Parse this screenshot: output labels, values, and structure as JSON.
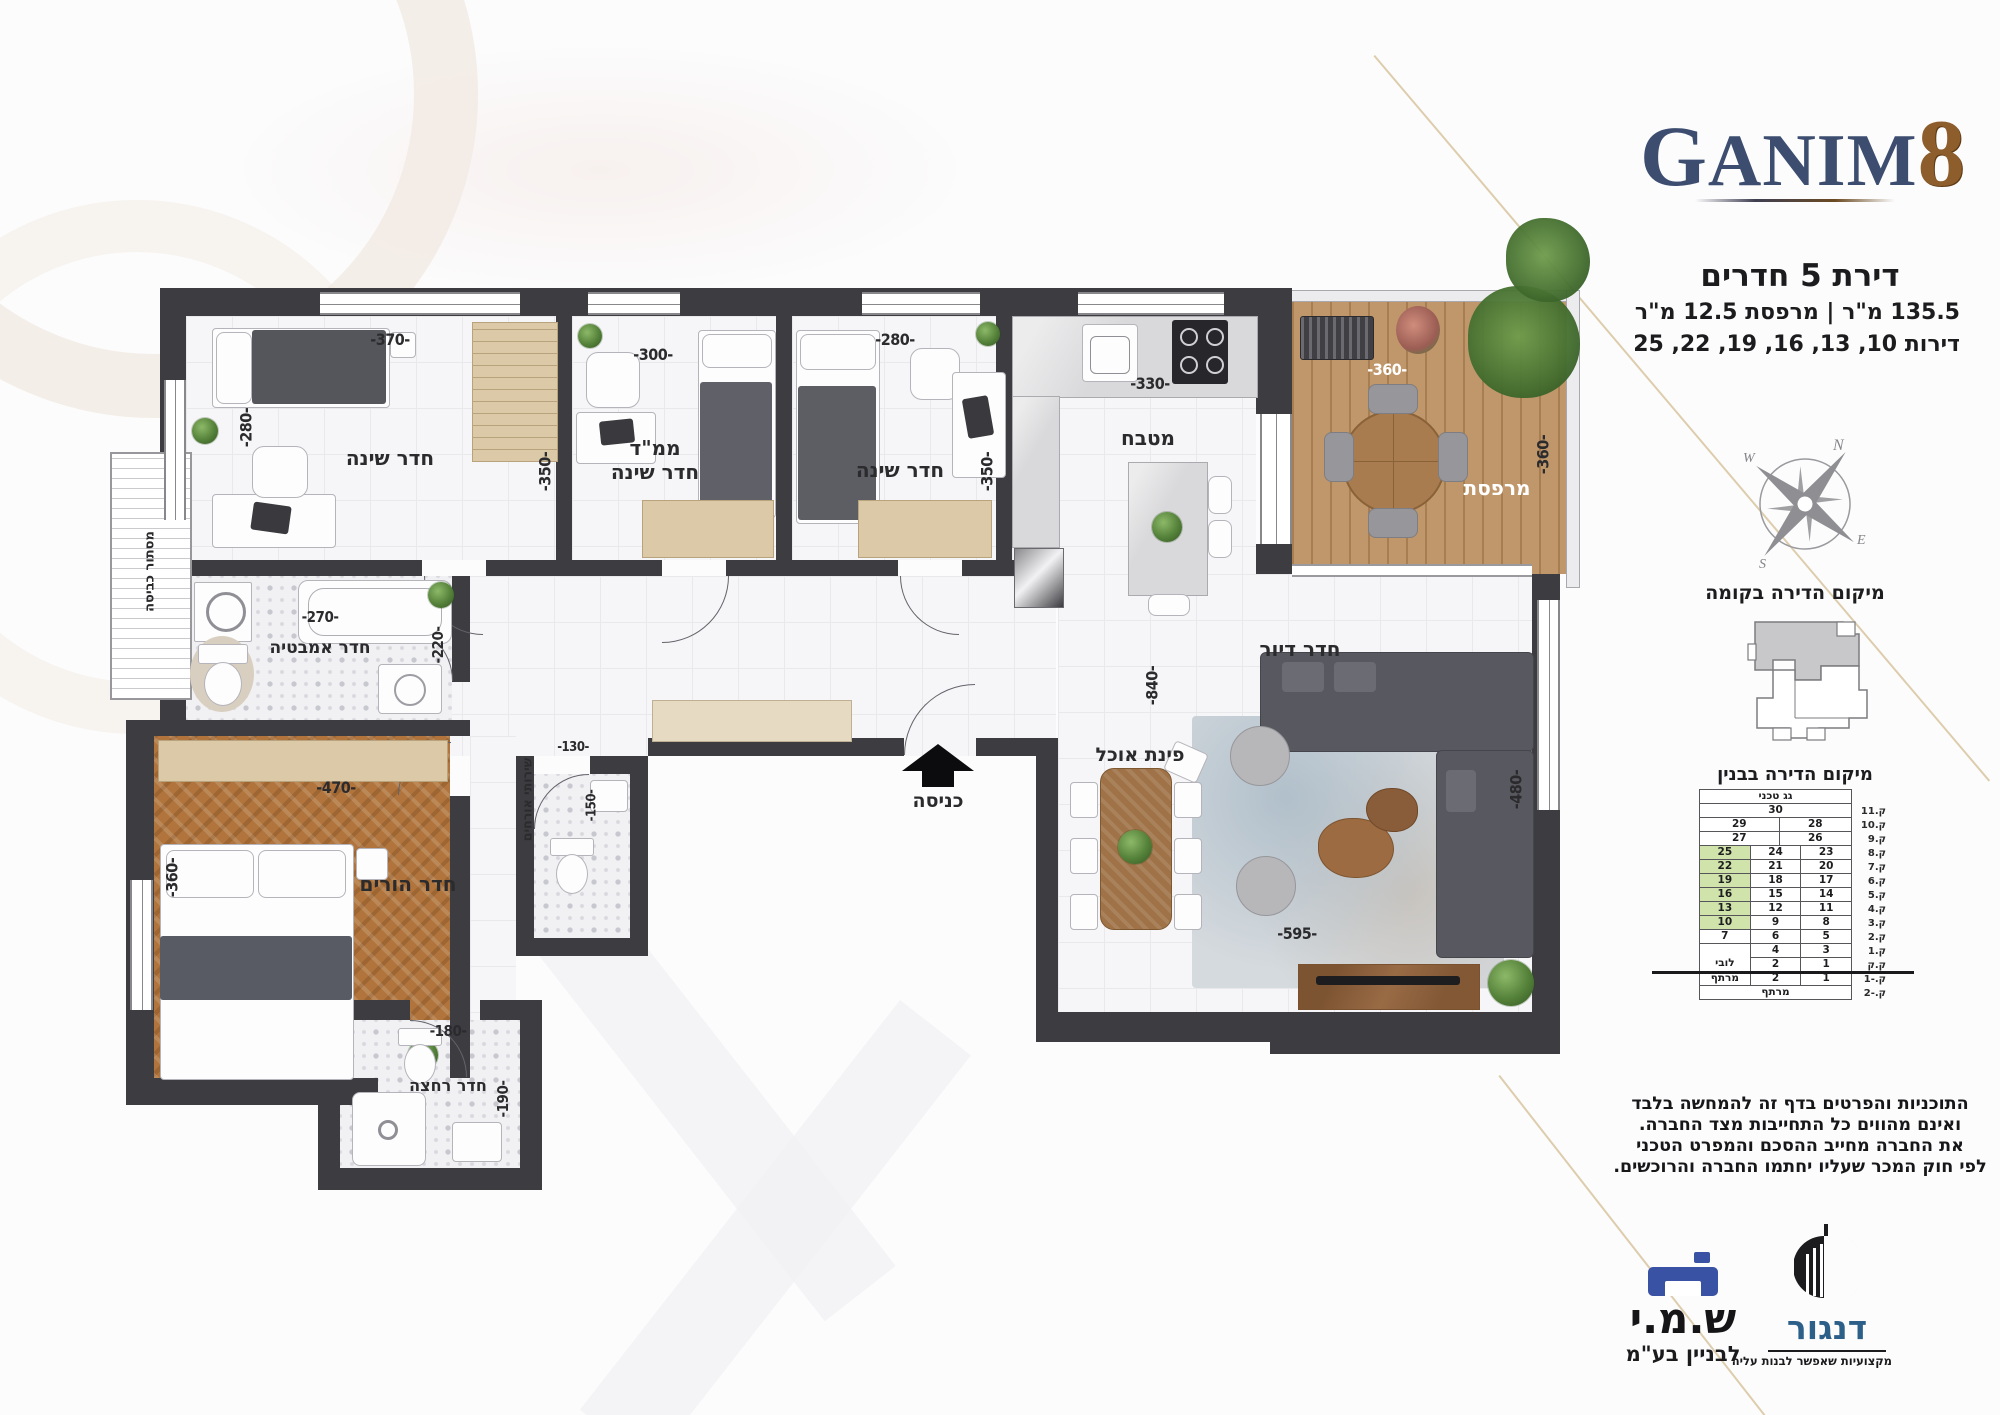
{
  "header": {
    "logo_text": "Ganim",
    "logo_number": "8",
    "title": "דירת 5 חדרים",
    "area_line": "135.5 מ\"ר | מרפסת 12.5 מ\"ר",
    "units_line": "דירות 10, 13, 16, 19, 22, 25"
  },
  "compass": {
    "n": "N",
    "e": "E",
    "s": "S",
    "w": "W"
  },
  "floor_location": {
    "title": "מיקום הדירה בקומה"
  },
  "building_location": {
    "title": "מיקום הדירה בבנין",
    "rows": [
      {
        "cells": [
          {
            "t": "גג טכני",
            "g": 1
          }
        ],
        "floor": ""
      },
      {
        "cells": [
          {
            "t": "30",
            "g": 1
          }
        ],
        "floor": "ק.11"
      },
      {
        "cells": [
          {
            "t": "29",
            "g": 1.1
          },
          {
            "t": "28",
            "g": 1
          }
        ],
        "floor": "ק.10"
      },
      {
        "cells": [
          {
            "t": "27",
            "g": 1.1
          },
          {
            "t": "26",
            "g": 1
          }
        ],
        "floor": "ק.9"
      },
      {
        "cells": [
          {
            "t": "25",
            "hl": true
          },
          {
            "t": "24"
          },
          {
            "t": "23"
          }
        ],
        "floor": "ק.8"
      },
      {
        "cells": [
          {
            "t": "22",
            "hl": true
          },
          {
            "t": "21"
          },
          {
            "t": "20"
          }
        ],
        "floor": "ק.7"
      },
      {
        "cells": [
          {
            "t": "19",
            "hl": true
          },
          {
            "t": "18"
          },
          {
            "t": "17"
          }
        ],
        "floor": "ק.6"
      },
      {
        "cells": [
          {
            "t": "16",
            "hl": true
          },
          {
            "t": "15"
          },
          {
            "t": "14"
          }
        ],
        "floor": "ק.5"
      },
      {
        "cells": [
          {
            "t": "13",
            "hl": true
          },
          {
            "t": "12"
          },
          {
            "t": "11"
          }
        ],
        "floor": "ק.4"
      },
      {
        "cells": [
          {
            "t": "10",
            "hl": true
          },
          {
            "t": "9"
          },
          {
            "t": "8"
          }
        ],
        "floor": "ק.3"
      },
      {
        "cells": [
          {
            "t": "7"
          },
          {
            "t": "6"
          },
          {
            "t": "5"
          }
        ],
        "floor": "ק.2"
      },
      {
        "cells": [
          {
            "t": "",
            "merge": "nb"
          },
          {
            "t": "4"
          },
          {
            "t": "3"
          }
        ],
        "floor": "ק.1"
      },
      {
        "cells": [
          {
            "t": "לובי",
            "merge": "nt"
          },
          {
            "t": "2"
          },
          {
            "t": "1"
          }
        ],
        "floor": "ק.ק"
      },
      {
        "cells": [
          {
            "t": "מרתף"
          },
          {
            "t": "2"
          },
          {
            "t": "1"
          }
        ],
        "floor": "ק.-1"
      },
      {
        "cells": [
          {
            "t": "מרתף",
            "g": 1
          }
        ],
        "floor": "ק.-2"
      }
    ]
  },
  "disclaimer": [
    "התוכניות והפרטים בדף זה להמחשה בלבד",
    "ואינם מהווים כל התחייבות מצד החברה.",
    "את החברה מחייב ההסכם והמפרט הטכני",
    "לפי חוק המכר שעליו יחתמו החברה והרוכשים."
  ],
  "brands": {
    "shami": {
      "name": "ש.מ.י",
      "sub": "לבניין בע\"מ"
    },
    "dangor": {
      "name": "דנגור",
      "tagline": "מקצועיות שאפשר לבנות עליה"
    }
  },
  "plan": {
    "entrance_label": "כניסה",
    "rooms": {
      "bedroom1": {
        "label": "חדר שינה",
        "dim_w": "-370-",
        "dim_h": "-280-"
      },
      "mamad": {
        "label_line1": "ממ\"ד",
        "label_line2": "חדר שינה",
        "dim_w": "-300-",
        "dim_h": "-350-"
      },
      "bedroom2": {
        "label": "חדר שינה",
        "dim_w": "-280-",
        "dim_h": "-350-"
      },
      "kitchen": {
        "label": "מטבח",
        "dim_w": "-330-"
      },
      "balcony": {
        "label": "מרפסת",
        "dim_w": "-360-",
        "dim_h": "-360-"
      },
      "bathroom": {
        "label": "חדר אמבטיה",
        "dim_w": "-270-",
        "dim_h": "-220-"
      },
      "guest_wc": {
        "label": "שירותי אורחים",
        "dim_w": "-130-",
        "dim_h": "-150-"
      },
      "shower": {
        "label": "חדר רחצה",
        "dim_w": "-180-",
        "dim_h": "-190-"
      },
      "master": {
        "label": "חדר הורים",
        "dim_w": "-470-",
        "dim_h": "-360-"
      },
      "living": {
        "label": "חדר דיור",
        "dim_depth": "-840-",
        "dim_e": "-480-",
        "dim_s": "-595-"
      },
      "dining": {
        "label": "פינת אוכל"
      },
      "laundry": {
        "label": "מסתור כביסה"
      }
    }
  }
}
